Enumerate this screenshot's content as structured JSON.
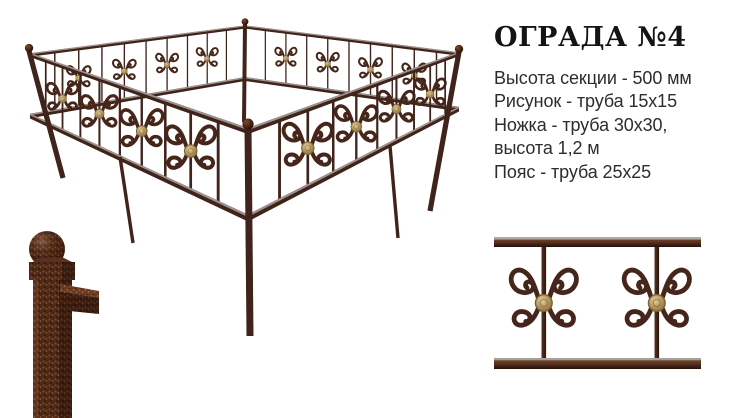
{
  "product": {
    "title": "ОГРАДА №4",
    "specs": [
      "Высота секции - 500 мм",
      "Рисунок - труба 15x15",
      "Ножка - труба 30x30,",
      "высота 1,2 м",
      "Пояс - труба 25x25"
    ]
  },
  "colors": {
    "background": "#ffffff",
    "metal_dark": "#40231a",
    "metal_mid": "#5d3321",
    "metal_light": "#7d4a2e",
    "rail_highlight": "#a29a93",
    "gold": "#c3a96f",
    "gold_dark": "#8a6f3e",
    "title_text": "#141414",
    "spec_text": "#2d2d2d"
  }
}
